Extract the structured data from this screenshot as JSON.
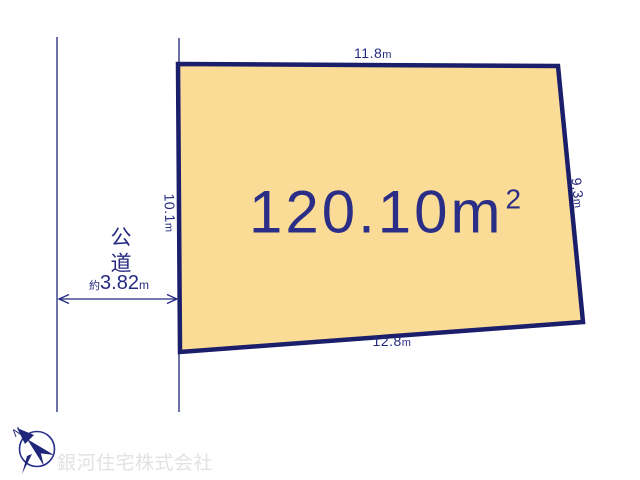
{
  "plot": {
    "area": {
      "value": "120.10",
      "unit": "m",
      "sup": "2"
    },
    "dims": {
      "top": {
        "value": "11.8",
        "unit": "m"
      },
      "right": {
        "value": "9.3",
        "unit": "m"
      },
      "bottom": {
        "value": "12.8",
        "unit": "m"
      },
      "left": {
        "value": "10.1",
        "unit": "m"
      }
    },
    "colors": {
      "fill": "#fadc96",
      "border": "#1a1e6b",
      "text": "#262a80"
    }
  },
  "road": {
    "label": "公道",
    "width": {
      "prefix": "約",
      "value": "3.82",
      "unit": "m"
    }
  },
  "compass": {
    "letter": "N"
  },
  "watermark": {
    "company": "銀河住宅株式会社"
  }
}
